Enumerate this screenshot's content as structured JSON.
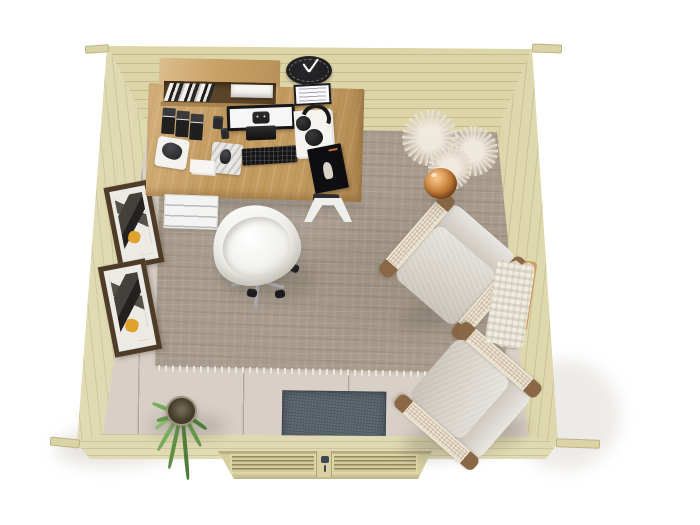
{
  "scene": {
    "description": "Top-down 3D render of a wooden garden office cabin interior",
    "view": "overhead",
    "background": "#ffffff"
  },
  "colors": {
    "wall_wood": "#dcd5a8",
    "wall_wood_shade": "#c6bf90",
    "floor_tile": "#d8d0c7",
    "grout": "#b9b0a4",
    "rug": "#a69a8c",
    "rug_fringe": "#f1ece2",
    "doormat": "#5a646e",
    "desk_wood": "#c39b60",
    "shelf_wood": "#c9a268",
    "drawer_white": "#f3f3f1",
    "office_chair_shell": "#f0efeb",
    "armchair_cushion": "#d8d3ca",
    "armchair_wood": "#8a6745",
    "armchair_webbing": "#ece4d2",
    "clock_black": "#1d1d1f",
    "monitor_black": "#17171a",
    "monitor_screen": "#f6f6f6",
    "keyboard_black": "#151517",
    "magazine_black": "#0e0e10",
    "magazine_accent": "#c96a3a",
    "paper_white": "#f5f4f1",
    "plant_green": "#5f8f47",
    "plant_green_light": "#7fae63",
    "plant_pot": "#46402c",
    "pampas_fluff": "#ddd3c6",
    "vase_amber": "#c8813d",
    "throw_white": "#f0ece1",
    "throw_ladder_wood": "#d9a768",
    "frame_brown": "#4e3b28",
    "frame_art_yellow": "#e0a22b",
    "door_wood": "#d6ce9e"
  },
  "objects": {
    "walls": [
      "back-wall",
      "left-wall",
      "right-wall",
      "front-wall"
    ],
    "door": "double-louvered-door",
    "floor": [
      "tile-floor",
      "area-rug",
      "doormat"
    ],
    "furniture": [
      "corner-desk",
      "desk-drawer-unit",
      "desk-trestle-leg",
      "wall-shelf",
      "office-chair",
      "armchair-upper",
      "armchair-lower"
    ],
    "desk_items": [
      "monitor",
      "monitor-stand",
      "keyboard",
      "mouse-pad",
      "mouse",
      "headphones",
      "paper-stack",
      "magazine",
      "magazine-files",
      "pen-cup",
      "desk-pad",
      "desk-accessory",
      "note-cards"
    ],
    "wall_items": [
      "wall-clock",
      "memo-board",
      "picture-frame-upper",
      "picture-frame-lower"
    ],
    "decor": [
      "pampas-grass-plant",
      "amber-glass-vase",
      "chunky-knit-throw",
      "blanket-ladder",
      "potted-palm-plant"
    ]
  }
}
